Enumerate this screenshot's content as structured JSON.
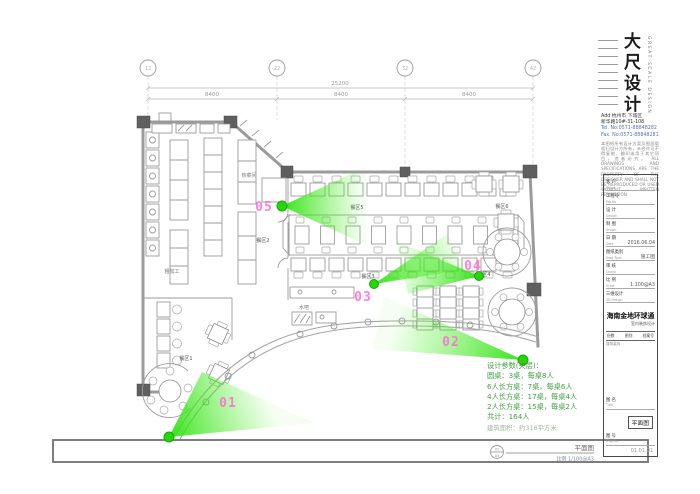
{
  "colors": {
    "cone_green": "#2be10c",
    "marker_pink": "#ff6ed6",
    "note_green": "#44a044",
    "tel_blue": "#5571b5"
  },
  "grid": {
    "bubbles": [
      "12",
      "22",
      "32",
      "42"
    ],
    "total_dim": "25200",
    "segment_dims": [
      "8400",
      "8400",
      "8400"
    ]
  },
  "plan": {
    "areas": [
      {
        "label": "餐区1"
      },
      {
        "label": "餐区2"
      },
      {
        "label": "餐区3"
      },
      {
        "label": "餐区4"
      },
      {
        "label": "餐区5"
      },
      {
        "label": "餐区6"
      }
    ],
    "rooms": [
      {
        "label": "热菜间"
      },
      {
        "label": "粗加工"
      },
      {
        "label": "水吧"
      }
    ],
    "cameras": [
      {
        "id": "01"
      },
      {
        "id": "02"
      },
      {
        "id": "03"
      },
      {
        "id": "04"
      },
      {
        "id": "05"
      }
    ],
    "drawing_title": {
      "name": "平面图",
      "scale": "比例 1/100@A3",
      "detail_top": "01",
      "detail_bottom": "A3"
    }
  },
  "notes": {
    "lines": [
      "设计参数(夹层)：",
      "圆桌：3桌，每桌8人",
      "6人长方桌：7桌，每桌6人",
      "4人长方桌：17桌，每桌4人",
      "2人长方桌：15桌，每桌2人",
      "共计：164人",
      "建筑面积：约316平方米"
    ]
  },
  "titleblock": {
    "logo_text": "大尺设计",
    "logo_en": "GREAT SCALE DESIGN",
    "address_line1": "Add 杭州市 下城区",
    "address_line2": "新华路10#-31-108",
    "tel": "Tel. No:0571-88848282",
    "fax": "Fax. No:0571-88848281",
    "disclaimer_cn": "本图纸所有设计方案及图面版权归设计方所有，未经许可不得复制、翻印或用于其它项目，违者必究。",
    "disclaimer_en": "ALL DRAWINGS AND SPECIFICATIONS ARE THE PROPERTY OF THE DESIGNER AND SHALL NOT BE REPRODUCED OR USED WITHOUT WRITTEN PERMISSION.",
    "rows": [
      {
        "label": "客 户",
        "sub": "Client",
        "value": ""
      },
      {
        "label": "工程号",
        "sub": "Pro.No",
        "value": ""
      },
      {
        "label": "设 计",
        "sub": "Design",
        "value": ""
      },
      {
        "label": "制 图",
        "sub": "Drawn",
        "value": ""
      },
      {
        "label": "日 期",
        "sub": "Date",
        "value": "2016.06.04"
      },
      {
        "label": "图纸类别",
        "sub": "Dwg.Type",
        "value": "施工图"
      },
      {
        "label": "审 核",
        "sub": "Check",
        "value": ""
      },
      {
        "label": "比 例",
        "sub": "Scale",
        "value": "1:100@A3"
      },
      {
        "label": "三维设计",
        "sub": "3D.Design",
        "value": ""
      }
    ],
    "project_name": "海南金地环球通",
    "project_sub": "室内装饰设计",
    "table_header": [
      "份数",
      "图别",
      "档案号"
    ],
    "table_note": "建筑装饰",
    "title_label": "图 名",
    "title_sub": "Title",
    "stamp": "平面图",
    "dwgno_label": "图 号",
    "dwgno_sub": "Dwg.No",
    "dwgno_value": "01.01.01"
  }
}
